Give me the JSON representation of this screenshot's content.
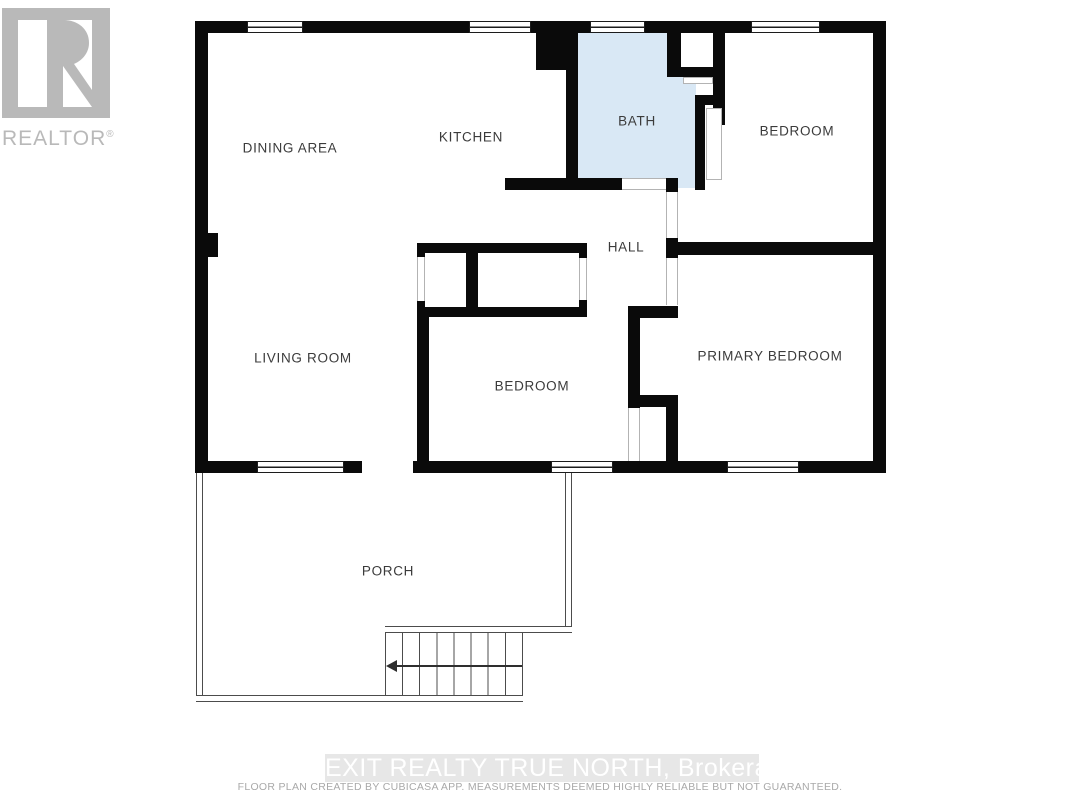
{
  "watermarks": {
    "realtor_text": "REALTOR",
    "realtor_reg": "®",
    "brokerage_banner": "EXIT REALTY TRUE NORTH, Brokerage",
    "disclaimer": "FLOOR PLAN CREATED BY CUBICASA APP. MEASUREMENTS DEEMED HIGHLY RELIABLE BUT NOT GUARANTEED."
  },
  "rooms": [
    {
      "label": "DINING AREA"
    },
    {
      "label": "KITCHEN"
    },
    {
      "label": "BATH"
    },
    {
      "label": "BEDROOM"
    },
    {
      "label": "HALL"
    },
    {
      "label": "LIVING ROOM"
    },
    {
      "label": "BEDROOM"
    },
    {
      "label": "PRIMARY BEDROOM"
    },
    {
      "label": "PORCH"
    }
  ],
  "colors": {
    "wall": "#0a0a0a",
    "bath_fill": "#d9e8f5",
    "watermark_gray": "#b9b9b9",
    "label_text": "#3b3b3b",
    "porch_line": "#4c4c4c",
    "banner_bg": "#e7e7e7",
    "banner_text": "#ffffff"
  }
}
